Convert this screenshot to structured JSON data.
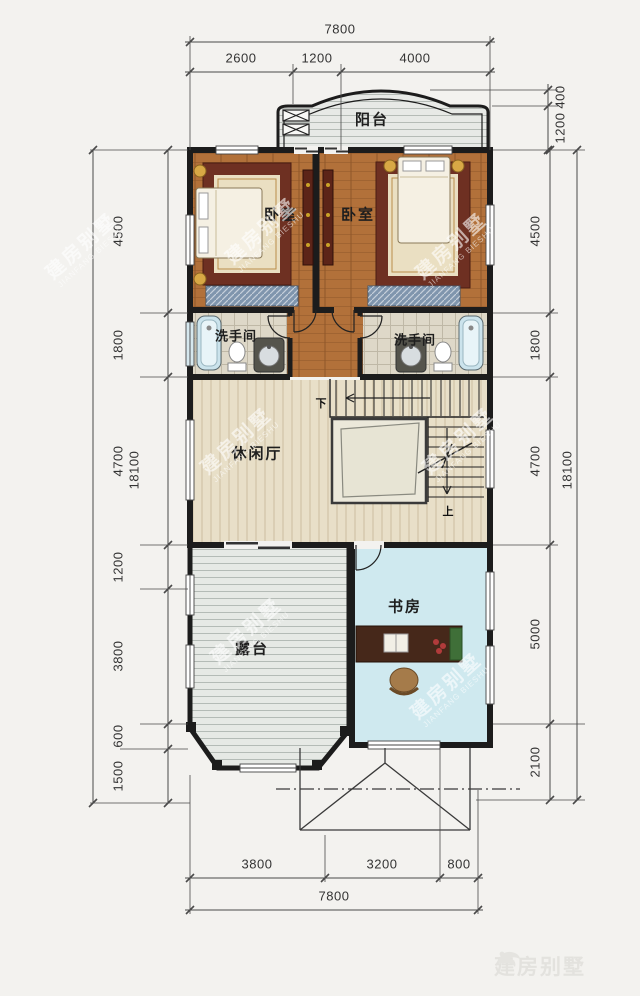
{
  "colors": {
    "background": "#f3f2ef",
    "wall": "#1c1c1c",
    "dim_line": "#4a4a4a",
    "dim_text": "#333333",
    "bedroom_floor": "#b2713a",
    "hall_floor": "#e8dfc8",
    "bathroom_floor": "#ded8c8",
    "study_floor": "#cfe9ef",
    "terrace_floor": "#e6e9e5",
    "balcony_floor": "#e7e9e6",
    "rug": "#6e3022",
    "rug_center": "#eadfc2",
    "bed": "#f5f0e3",
    "wardrobe": "#7f95ad",
    "bathtub": "#cbe3ec",
    "desk": "#46281a",
    "chair": "#a57b4a",
    "stair_void": "#ebe8da",
    "watermark": "rgba(255,255,255,0.6)",
    "logo": "#e3e2de"
  },
  "rooms": {
    "balcony": {
      "label": "阳台"
    },
    "bedroom_left": {
      "label": "卧室"
    },
    "bedroom_right": {
      "label": "卧室"
    },
    "bathroom_left": {
      "label": "洗手间"
    },
    "bathroom_right": {
      "label": "洗手间"
    },
    "hall": {
      "label": "休闲厅"
    },
    "study": {
      "label": "书房"
    },
    "terrace": {
      "label": "露台"
    }
  },
  "stairs": {
    "down_label": "下",
    "up_label": "上"
  },
  "dimensions": {
    "top": {
      "total": "7800",
      "segments": [
        "2600",
        "1200",
        "4000"
      ]
    },
    "upper_right": {
      "segments": [
        "400",
        "1200"
      ]
    },
    "right": {
      "segments": [
        "4500",
        "1800",
        "4700",
        "5000",
        "2100"
      ],
      "total": "18100"
    },
    "left": {
      "segments": [
        "4500",
        "1800",
        "4700",
        "1200",
        "3800",
        "600",
        "1500"
      ],
      "total": "18100"
    },
    "bottom": {
      "segments": [
        "3800",
        "3200",
        "800"
      ],
      "total": "7800"
    }
  },
  "watermark": {
    "cn": "建房别墅",
    "en": "JIANFANG BIESHU"
  },
  "logo": {
    "text": "建房别墅"
  }
}
